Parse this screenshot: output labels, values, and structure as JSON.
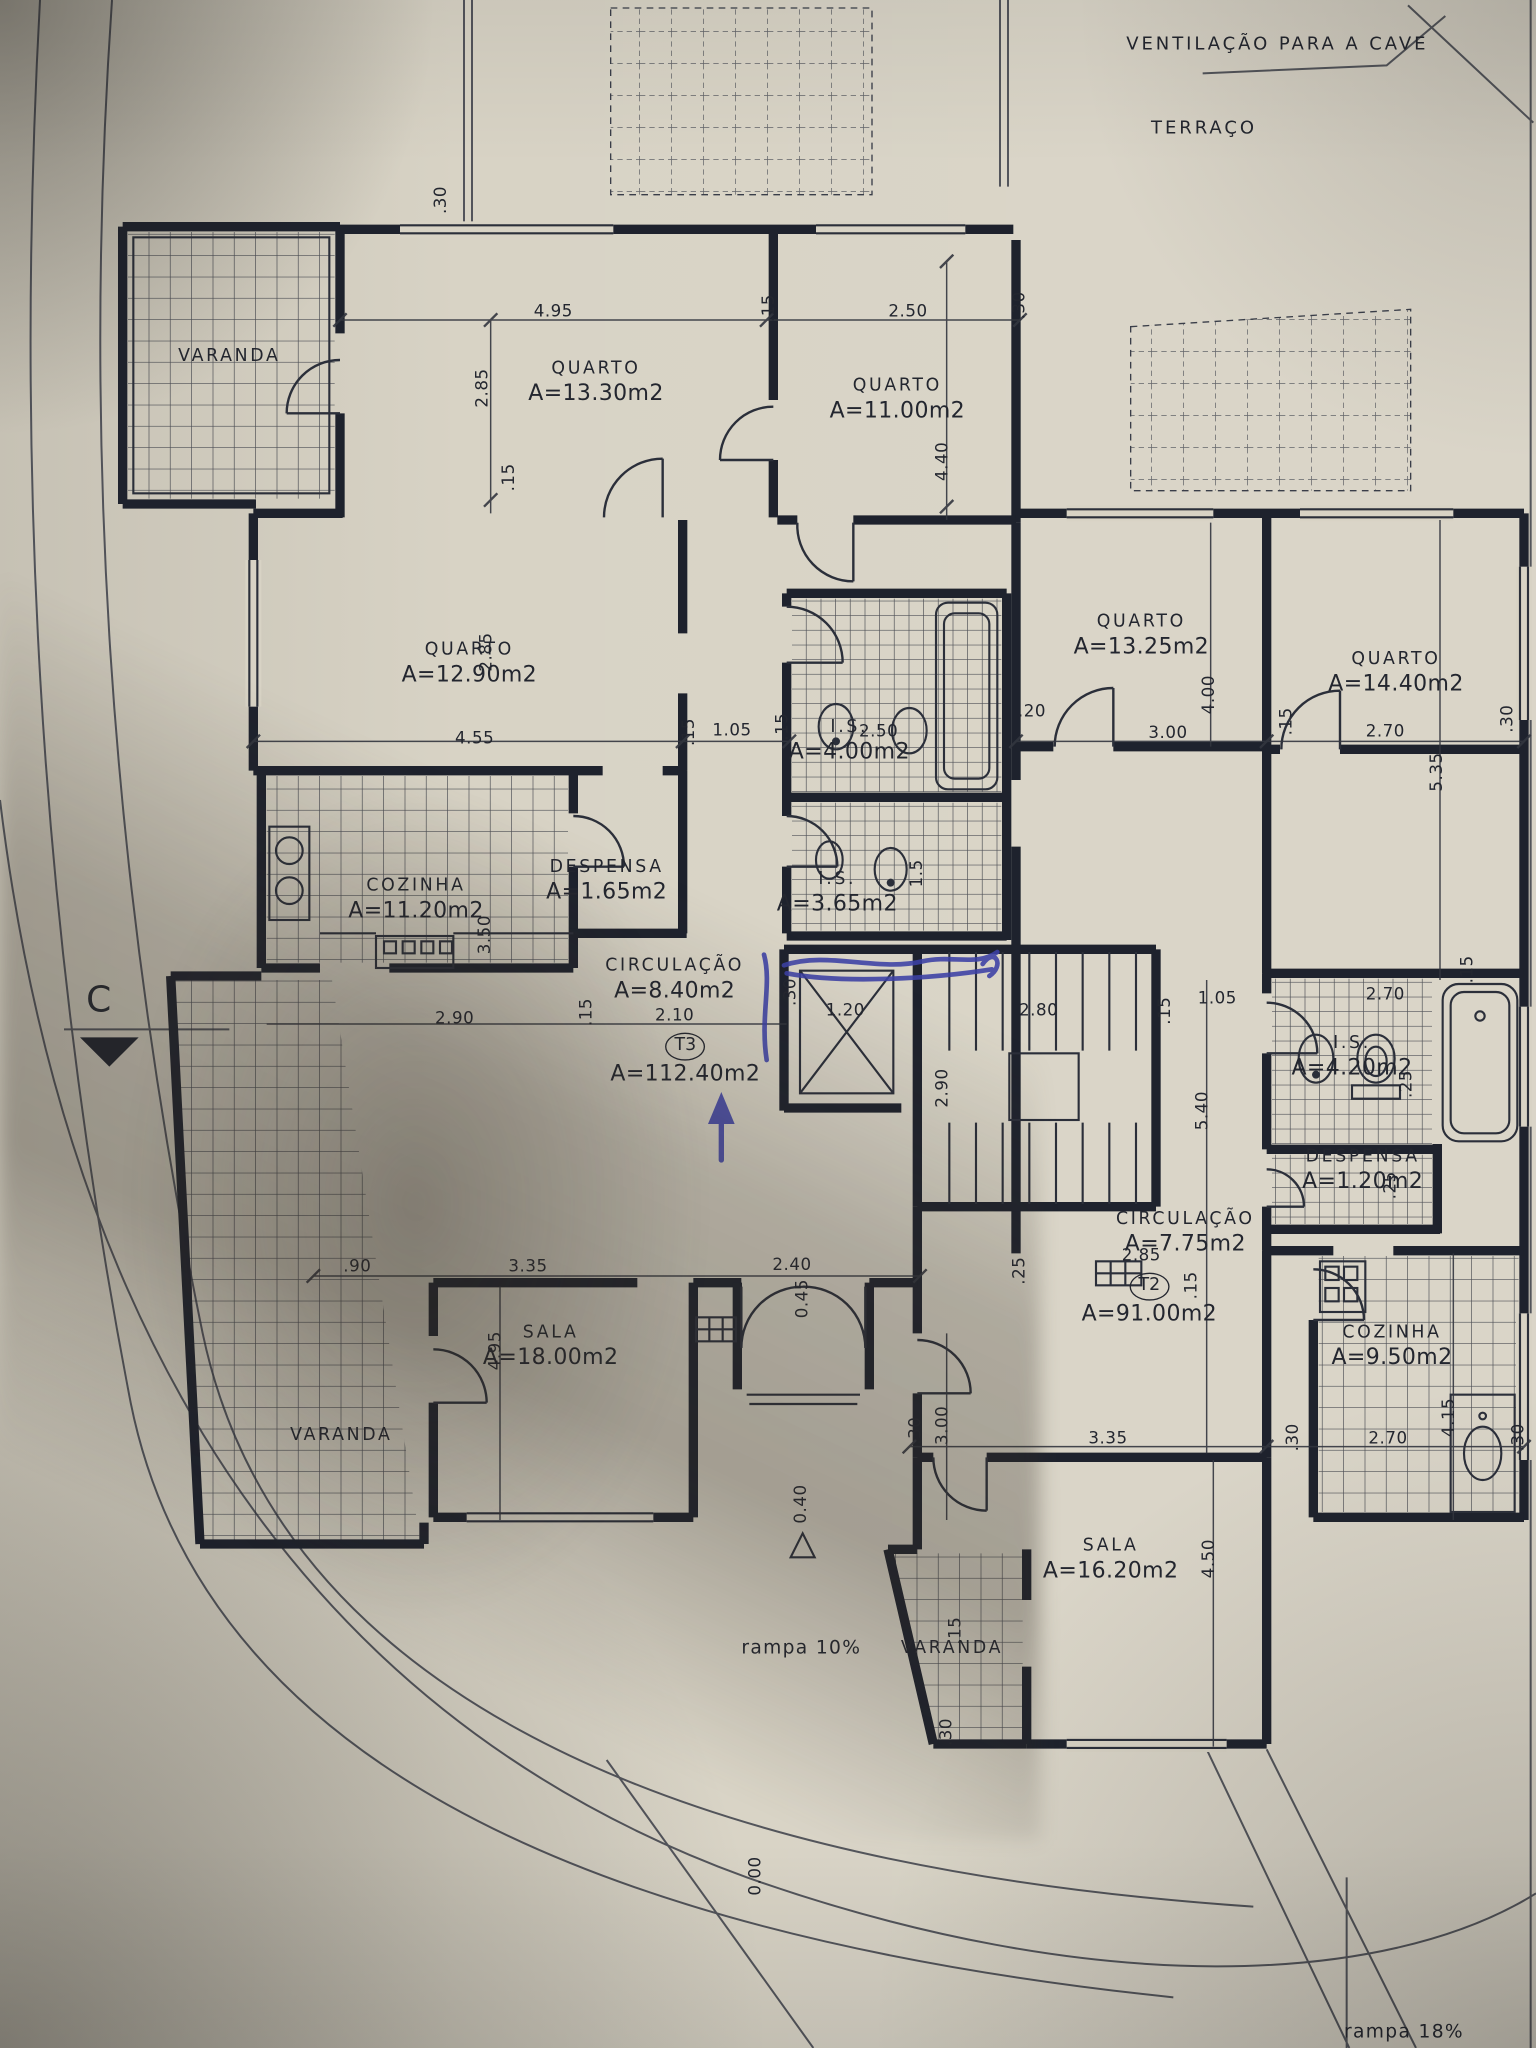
{
  "drawing": {
    "kind": "floor-plan-photo",
    "colors": {
      "paper": "#d8d3c5",
      "ink": "#23262f",
      "walls": "#1e222d",
      "pen_blue": "#3c41a6"
    }
  },
  "notes_static": {
    "ventilation": "VENTILAÇÃO PARA A CAVE",
    "terraco": "TERRAÇO",
    "rampa_left": "rampa 10%",
    "rampa_right": "rampa 18%",
    "section_marker": "C",
    "level_entrance": "0.40",
    "level_zero": "0.00"
  },
  "apartments": [
    {
      "code": "T3",
      "area": "A=112.40m2"
    },
    {
      "code": "T2",
      "area": "A=91.00m2"
    }
  ],
  "rooms": [
    {
      "label": "VARANDA",
      "area": null,
      "x": 172,
      "y": 268
    },
    {
      "label": "QUARTO",
      "area": "A=13.30m2",
      "x": 447,
      "y": 287
    },
    {
      "label": "QUARTO",
      "area": "A=11.00m2",
      "x": 673,
      "y": 300
    },
    {
      "label": "QUARTO",
      "area": "A=12.90m2",
      "x": 352,
      "y": 498
    },
    {
      "label": "QUARTO",
      "area": "A=13.25m2",
      "x": 856,
      "y": 477
    },
    {
      "label": "QUARTO",
      "area": "A=14.40m2",
      "x": 1047,
      "y": 505
    },
    {
      "label": "I.S.",
      "area": "A=4.00m2",
      "x": 637,
      "y": 556
    },
    {
      "label": "I.S.",
      "area": "A=3.65m2",
      "x": 628,
      "y": 670
    },
    {
      "label": "COZINHA",
      "area": "A=11.20m2",
      "x": 312,
      "y": 675
    },
    {
      "label": "DESPENSA",
      "area": "A=1.65m2",
      "x": 455,
      "y": 661
    },
    {
      "label": "CIRCULAÇÃO",
      "area": "A=8.40m2",
      "x": 506,
      "y": 735
    },
    {
      "label": "T3",
      "area": "A=112.40m2",
      "x": 514,
      "y": 795,
      "circled": true
    },
    {
      "label": "I.S.",
      "area": "A=4.20m2",
      "x": 1014,
      "y": 793
    },
    {
      "label": "DESPENSA",
      "area": "A=1.20m2",
      "x": 1022,
      "y": 878
    },
    {
      "label": "CIRCULAÇÃO",
      "area": "A=7.75m2",
      "x": 889,
      "y": 925
    },
    {
      "label": "T2",
      "area": "A=91.00m2",
      "x": 862,
      "y": 975,
      "circled": true
    },
    {
      "label": "COZINHA",
      "area": "A=9.50m2",
      "x": 1044,
      "y": 1010
    },
    {
      "label": "SALA",
      "area": "A=18.00m2",
      "x": 413,
      "y": 1010
    },
    {
      "label": "SALA",
      "area": "A=16.20m2",
      "x": 833,
      "y": 1170
    },
    {
      "label": "VARANDA",
      "area": null,
      "x": 256,
      "y": 1077
    },
    {
      "label": "VARANDA",
      "area": null,
      "x": 714,
      "y": 1237
    }
  ],
  "dimensions": [
    {
      "t": ".30",
      "x": 330,
      "y": 150,
      "r": -90
    },
    {
      "t": "4.95",
      "x": 415,
      "y": 233
    },
    {
      "t": ".15",
      "x": 576,
      "y": 231,
      "r": -90
    },
    {
      "t": "2.50",
      "x": 681,
      "y": 233
    },
    {
      "t": ".30",
      "x": 764,
      "y": 229,
      "r": -90
    },
    {
      "t": "2.85",
      "x": 361,
      "y": 291,
      "r": -90
    },
    {
      "t": "4.40",
      "x": 706,
      "y": 346,
      "r": -90
    },
    {
      "t": ".15",
      "x": 381,
      "y": 358,
      "r": -90
    },
    {
      "t": "2.85",
      "x": 364,
      "y": 489,
      "r": -90
    },
    {
      "t": "4.55",
      "x": 356,
      "y": 553
    },
    {
      "t": ".15",
      "x": 516,
      "y": 549,
      "r": -90
    },
    {
      "t": "1.05",
      "x": 549,
      "y": 547
    },
    {
      "t": ".15",
      "x": 586,
      "y": 545,
      "r": -90
    },
    {
      "t": "2.50",
      "x": 659,
      "y": 548
    },
    {
      "t": ".20",
      "x": 774,
      "y": 533
    },
    {
      "t": "3.00",
      "x": 876,
      "y": 549
    },
    {
      "t": ".15",
      "x": 964,
      "y": 541,
      "r": -90
    },
    {
      "t": "2.70",
      "x": 1039,
      "y": 548
    },
    {
      "t": ".30",
      "x": 1130,
      "y": 539,
      "r": -90
    },
    {
      "t": "4.00",
      "x": 906,
      "y": 521,
      "r": -90
    },
    {
      "t": "5.35",
      "x": 1077,
      "y": 579,
      "r": -90
    },
    {
      "t": "3.50",
      "x": 363,
      "y": 701,
      "r": -90
    },
    {
      "t": "1.5",
      "x": 687,
      "y": 655,
      "r": -90
    },
    {
      "t": "2.90",
      "x": 341,
      "y": 763
    },
    {
      "t": ".15",
      "x": 439,
      "y": 759,
      "r": -90
    },
    {
      "t": "2.10",
      "x": 506,
      "y": 761
    },
    {
      "t": "1.20",
      "x": 634,
      "y": 757
    },
    {
      "t": ".30",
      "x": 592,
      "y": 744,
      "r": -90
    },
    {
      "t": "2.80",
      "x": 779,
      "y": 757
    },
    {
      "t": ".15",
      "x": 873,
      "y": 758,
      "r": -90
    },
    {
      "t": "1.05",
      "x": 913,
      "y": 748
    },
    {
      "t": "2.70",
      "x": 1039,
      "y": 745
    },
    {
      "t": ".15",
      "x": 1100,
      "y": 727,
      "r": -90
    },
    {
      "t": "2.90",
      "x": 706,
      "y": 816,
      "r": -90
    },
    {
      "t": "5.40",
      "x": 901,
      "y": 833,
      "r": -90
    },
    {
      "t": ".25",
      "x": 1054,
      "y": 813,
      "r": -90
    },
    {
      "t": ".25",
      "x": 1042,
      "y": 889,
      "r": -90
    },
    {
      "t": ".90",
      "x": 268,
      "y": 949
    },
    {
      "t": "3.35",
      "x": 396,
      "y": 949
    },
    {
      "t": "2.40",
      "x": 594,
      "y": 948
    },
    {
      "t": "0.45",
      "x": 601,
      "y": 974,
      "r": -90
    },
    {
      "t": ".25",
      "x": 764,
      "y": 953,
      "r": -90
    },
    {
      "t": "2.85",
      "x": 856,
      "y": 941
    },
    {
      "t": ".15",
      "x": 893,
      "y": 964,
      "r": -90
    },
    {
      "t": "4.95",
      "x": 371,
      "y": 1013,
      "r": -90
    },
    {
      "t": "3.00",
      "x": 706,
      "y": 1069,
      "r": -90
    },
    {
      "t": ".30",
      "x": 686,
      "y": 1073,
      "r": -90
    },
    {
      "t": "3.35",
      "x": 831,
      "y": 1078
    },
    {
      "t": ".30",
      "x": 969,
      "y": 1078,
      "r": -90
    },
    {
      "t": "2.70",
      "x": 1041,
      "y": 1078
    },
    {
      "t": ".30",
      "x": 1138,
      "y": 1078,
      "r": -90
    },
    {
      "t": "4.15",
      "x": 1086,
      "y": 1063,
      "r": -90
    },
    {
      "t": "4.50",
      "x": 906,
      "y": 1169,
      "r": -90
    },
    {
      "t": ".15",
      "x": 716,
      "y": 1223,
      "r": -90
    },
    {
      "t": ".30",
      "x": 709,
      "y": 1299,
      "r": -90
    }
  ]
}
